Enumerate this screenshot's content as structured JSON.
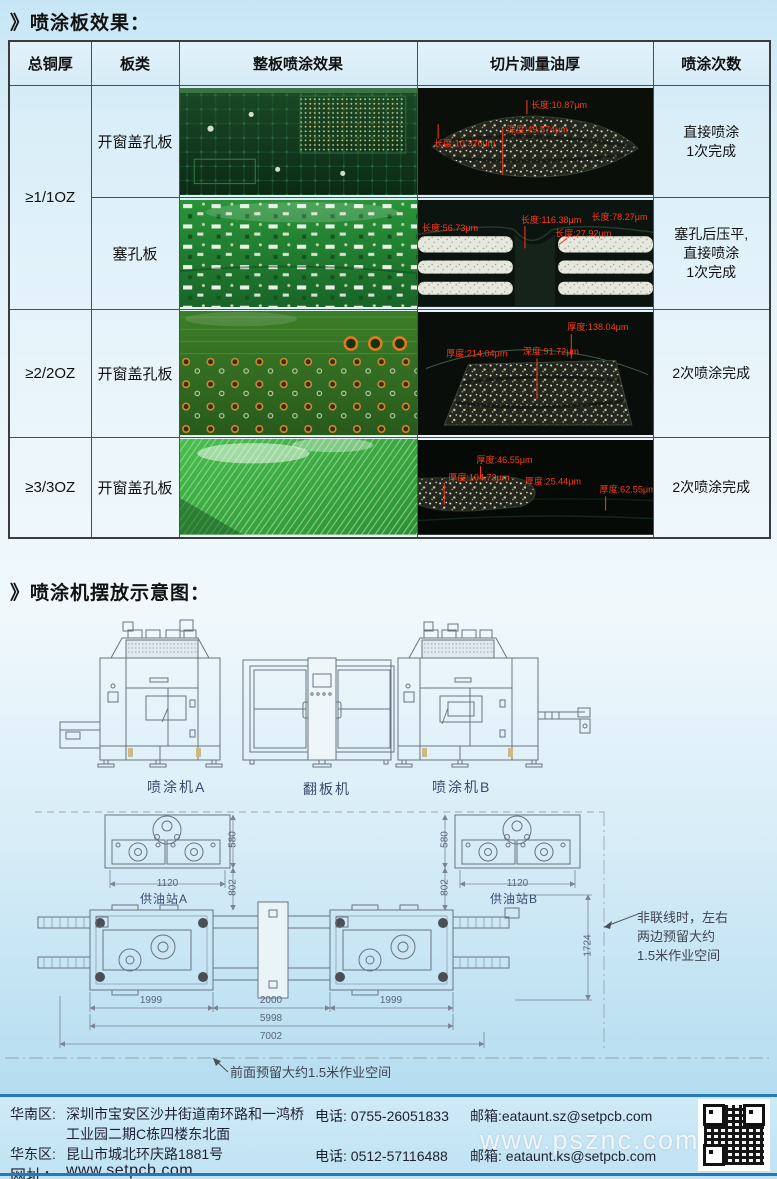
{
  "page": {
    "section1_title": "》喷涂板效果：",
    "section2_title": "》喷涂机摆放示意图："
  },
  "table": {
    "headers": [
      "总铜厚",
      "板类",
      "整板喷涂效果",
      "切片测量油厚",
      "喷涂次数"
    ],
    "rows": [
      {
        "copper": "≥1/1OZ",
        "board": "开窗盖孔板",
        "result": "直接喷涂\n1次完成"
      },
      {
        "board": "塞孔板",
        "result": "塞孔后压平,\n直接喷涂\n1次完成"
      },
      {
        "copper": "≥2/2OZ",
        "board": "开窗盖孔板",
        "result": "2次喷涂完成"
      },
      {
        "copper": "≥3/3OZ",
        "board": "开窗盖孔板",
        "result": "2次喷涂完成"
      }
    ],
    "micro": {
      "row1": [
        "长度:10.87μm",
        "深度:49.574μm",
        "长度:10.376μm"
      ],
      "row2": [
        "长度:116.38μm",
        "长度:78.27μm",
        "长度:56.73μm",
        "长度:27.92μm"
      ],
      "row3": [
        "厚度:138.04μm",
        "厚度:214.04μm",
        "深度:91.72μm"
      ],
      "row4": [
        "厚度:46.55μm",
        "厚度:104.73μm",
        "厚度:25.44μm",
        "厚度:62.55μm"
      ]
    }
  },
  "diagram": {
    "machine_a": "喷涂机A",
    "flipper": "翻板机",
    "machine_b": "喷涂机B",
    "station_a": "供油站A",
    "station_b": "供油站B",
    "dims": {
      "station_width": "1120",
      "station_depth": "580",
      "station_gap": "802",
      "machine_a_len": "1999",
      "flipper_len": "2000",
      "machine_b_len": "1999",
      "line_len": "5998",
      "total_len": "7002",
      "depth": "1724"
    },
    "side_note": "非联线时，左右\n两边预留大约\n1.5米作业空间",
    "front_note": "前面预留大约1.5米作业空间"
  },
  "footer": {
    "south_label": "华南区:",
    "south_address1": "深圳市宝安区沙井街道南环路和一鸿桥",
    "south_address2": "工业园二期C栋四楼东北面",
    "east_label": "华东区:",
    "east_address": "昆山市城北环庆路1881号",
    "web_label": "网址：",
    "website": "www.setpcb.com",
    "phone1": "电话: 0755-26051833",
    "phone2": "电话: 0512-57116488",
    "email1": "邮箱:eataunt.sz@setpcb.com",
    "email2": "邮箱: eataunt.ks@setpcb.com",
    "watermark": "www.psznc.com"
  },
  "colors": {
    "footer_line": "#2679b8",
    "annotation_red": "#ff3a1a",
    "pcb_green": "#2e8f3c",
    "drawing_line": "#6a7480",
    "page_blue": "#c7e6f5"
  }
}
